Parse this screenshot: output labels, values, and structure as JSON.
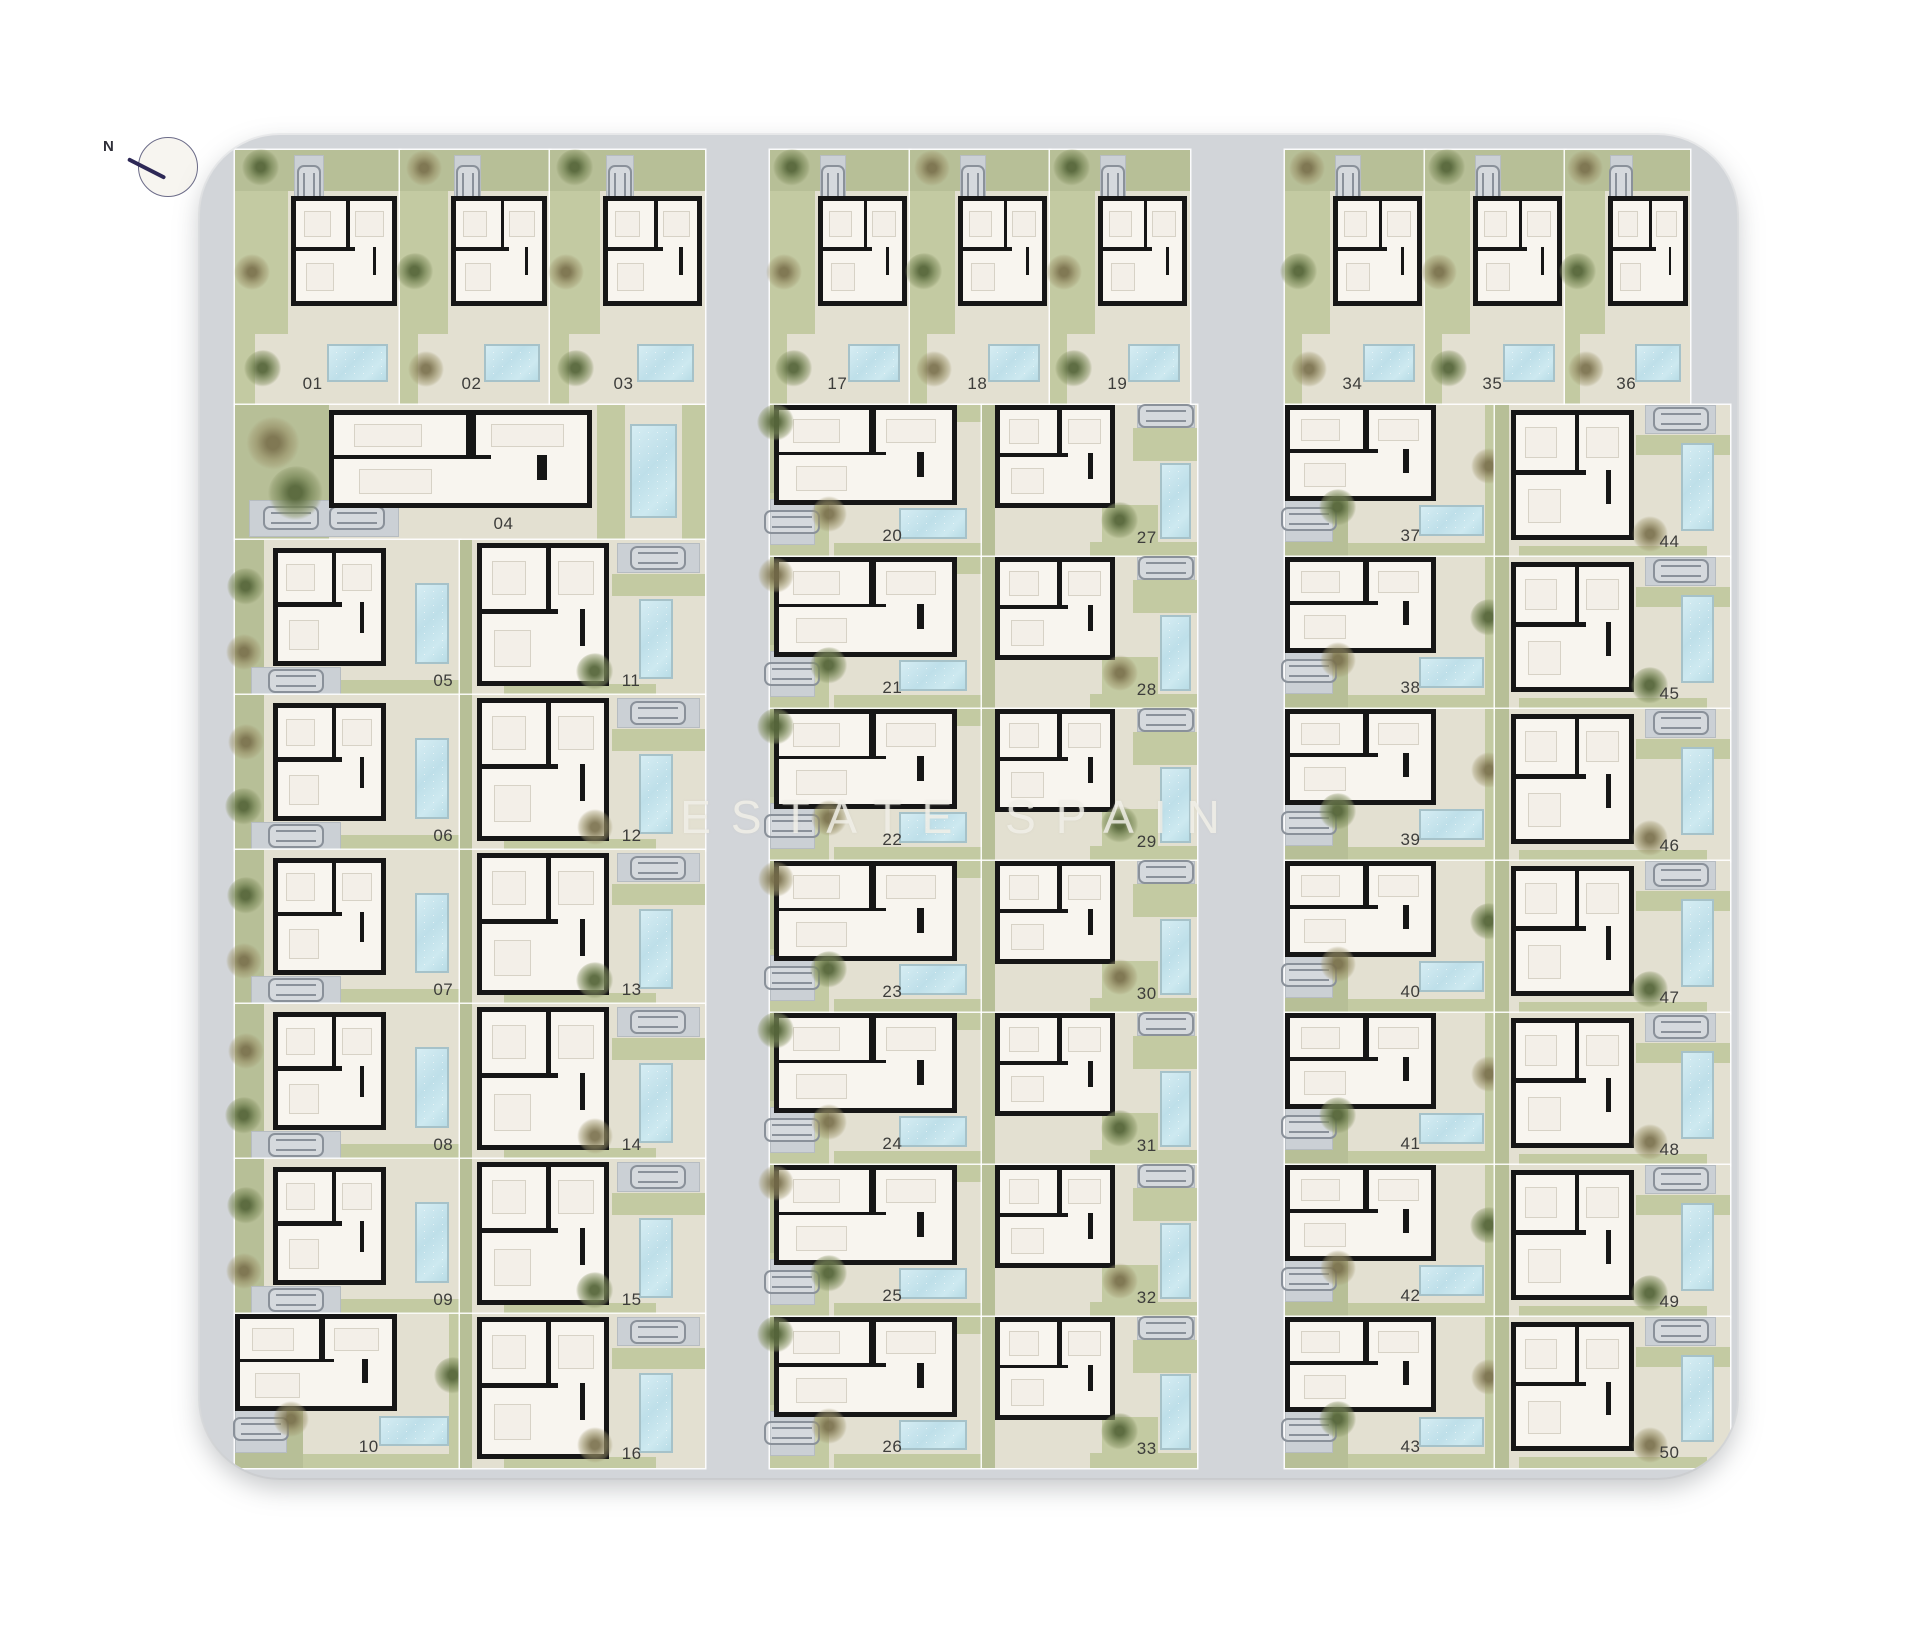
{
  "compass": {
    "label": "N"
  },
  "watermark": {
    "text": "ESTATE SPAIN"
  },
  "colors": {
    "road": "#d2d5d9",
    "plot_ground": "#e3e0d1",
    "garden_green": "#c3caa2",
    "pool_blue": "#bedfe9",
    "house_fill": "#f8f5ef",
    "wall_black": "#161616",
    "parking_gray": "#cbd0d5",
    "number_text": "#3d3d3b",
    "compass_needle": "#2d2856"
  },
  "site": {
    "x": 200,
    "y": 135,
    "w": 1537,
    "h": 1343,
    "radius": 80
  },
  "plots": [
    {
      "num": "01",
      "type": "rowTop",
      "x": 235,
      "y": 150,
      "w": 165,
      "h": 255
    },
    {
      "num": "02",
      "type": "rowTop",
      "x": 400,
      "y": 150,
      "w": 150,
      "h": 255
    },
    {
      "num": "03",
      "type": "rowTop",
      "x": 550,
      "y": 150,
      "w": 155,
      "h": 255
    },
    {
      "num": "04",
      "type": "wide",
      "x": 235,
      "y": 405,
      "w": 470,
      "h": 135
    },
    {
      "num": "05",
      "type": "B",
      "x": 235,
      "y": 540,
      "w": 225,
      "h": 155
    },
    {
      "num": "06",
      "type": "B",
      "x": 235,
      "y": 695,
      "w": 225,
      "h": 155
    },
    {
      "num": "07",
      "type": "B",
      "x": 235,
      "y": 850,
      "w": 225,
      "h": 154
    },
    {
      "num": "08",
      "type": "B",
      "x": 235,
      "y": 1004,
      "w": 225,
      "h": 155
    },
    {
      "num": "09",
      "type": "B",
      "x": 235,
      "y": 1159,
      "w": 225,
      "h": 155
    },
    {
      "num": "10",
      "type": "F",
      "x": 235,
      "y": 1314,
      "w": 225,
      "h": 154
    },
    {
      "num": "11",
      "type": "C",
      "x": 460,
      "y": 540,
      "w": 245,
      "h": 155
    },
    {
      "num": "12",
      "type": "C",
      "x": 460,
      "y": 695,
      "w": 245,
      "h": 155
    },
    {
      "num": "13",
      "type": "C",
      "x": 460,
      "y": 850,
      "w": 245,
      "h": 154
    },
    {
      "num": "14",
      "type": "C",
      "x": 460,
      "y": 1004,
      "w": 245,
      "h": 155
    },
    {
      "num": "15",
      "type": "C",
      "x": 460,
      "y": 1159,
      "w": 245,
      "h": 155
    },
    {
      "num": "16",
      "type": "C",
      "x": 460,
      "y": 1314,
      "w": 245,
      "h": 154
    },
    {
      "num": "17",
      "type": "rowTop",
      "x": 770,
      "y": 150,
      "w": 140,
      "h": 255
    },
    {
      "num": "18",
      "type": "rowTop",
      "x": 910,
      "y": 150,
      "w": 140,
      "h": 255
    },
    {
      "num": "19",
      "type": "rowTop",
      "x": 1050,
      "y": 150,
      "w": 140,
      "h": 255
    },
    {
      "num": "20",
      "type": "D",
      "x": 770,
      "y": 405,
      "w": 212,
      "h": 152
    },
    {
      "num": "21",
      "type": "D",
      "x": 770,
      "y": 557,
      "w": 212,
      "h": 152
    },
    {
      "num": "22",
      "type": "D",
      "x": 770,
      "y": 709,
      "w": 212,
      "h": 152
    },
    {
      "num": "23",
      "type": "D",
      "x": 770,
      "y": 861,
      "w": 212,
      "h": 152
    },
    {
      "num": "24",
      "type": "D",
      "x": 770,
      "y": 1013,
      "w": 212,
      "h": 152
    },
    {
      "num": "25",
      "type": "D",
      "x": 770,
      "y": 1165,
      "w": 212,
      "h": 152
    },
    {
      "num": "26",
      "type": "D",
      "x": 770,
      "y": 1317,
      "w": 212,
      "h": 151
    },
    {
      "num": "27",
      "type": "E",
      "x": 982,
      "y": 405,
      "w": 215,
      "h": 152
    },
    {
      "num": "28",
      "type": "E",
      "x": 982,
      "y": 557,
      "w": 215,
      "h": 152
    },
    {
      "num": "29",
      "type": "E",
      "x": 982,
      "y": 709,
      "w": 215,
      "h": 152
    },
    {
      "num": "30",
      "type": "E",
      "x": 982,
      "y": 861,
      "w": 215,
      "h": 152
    },
    {
      "num": "31",
      "type": "E",
      "x": 982,
      "y": 1013,
      "w": 215,
      "h": 152
    },
    {
      "num": "32",
      "type": "E",
      "x": 982,
      "y": 1165,
      "w": 215,
      "h": 152
    },
    {
      "num": "33",
      "type": "E",
      "x": 982,
      "y": 1317,
      "w": 215,
      "h": 151
    },
    {
      "num": "34",
      "type": "rowTop",
      "x": 1285,
      "y": 150,
      "w": 140,
      "h": 255
    },
    {
      "num": "35",
      "type": "rowTop",
      "x": 1425,
      "y": 150,
      "w": 140,
      "h": 255
    },
    {
      "num": "36",
      "type": "rowTop",
      "x": 1565,
      "y": 150,
      "w": 125,
      "h": 255
    },
    {
      "num": "37",
      "type": "F",
      "x": 1285,
      "y": 405,
      "w": 210,
      "h": 152
    },
    {
      "num": "38",
      "type": "F",
      "x": 1285,
      "y": 557,
      "w": 210,
      "h": 152
    },
    {
      "num": "39",
      "type": "F",
      "x": 1285,
      "y": 709,
      "w": 210,
      "h": 152
    },
    {
      "num": "40",
      "type": "F",
      "x": 1285,
      "y": 861,
      "w": 210,
      "h": 152
    },
    {
      "num": "41",
      "type": "F",
      "x": 1285,
      "y": 1013,
      "w": 210,
      "h": 152
    },
    {
      "num": "42",
      "type": "F",
      "x": 1285,
      "y": 1165,
      "w": 210,
      "h": 152
    },
    {
      "num": "43",
      "type": "F",
      "x": 1285,
      "y": 1317,
      "w": 210,
      "h": 151
    },
    {
      "num": "44",
      "type": "G",
      "x": 1495,
      "y": 405,
      "w": 235,
      "h": 152
    },
    {
      "num": "45",
      "type": "G",
      "x": 1495,
      "y": 557,
      "w": 235,
      "h": 152
    },
    {
      "num": "46",
      "type": "G",
      "x": 1495,
      "y": 709,
      "w": 235,
      "h": 152
    },
    {
      "num": "47",
      "type": "G",
      "x": 1495,
      "y": 861,
      "w": 235,
      "h": 152
    },
    {
      "num": "48",
      "type": "G",
      "x": 1495,
      "y": 1013,
      "w": 235,
      "h": 152
    },
    {
      "num": "49",
      "type": "G",
      "x": 1495,
      "y": 1165,
      "w": 235,
      "h": 152
    },
    {
      "num": "50",
      "type": "G",
      "x": 1495,
      "y": 1317,
      "w": 235,
      "h": 151
    }
  ]
}
